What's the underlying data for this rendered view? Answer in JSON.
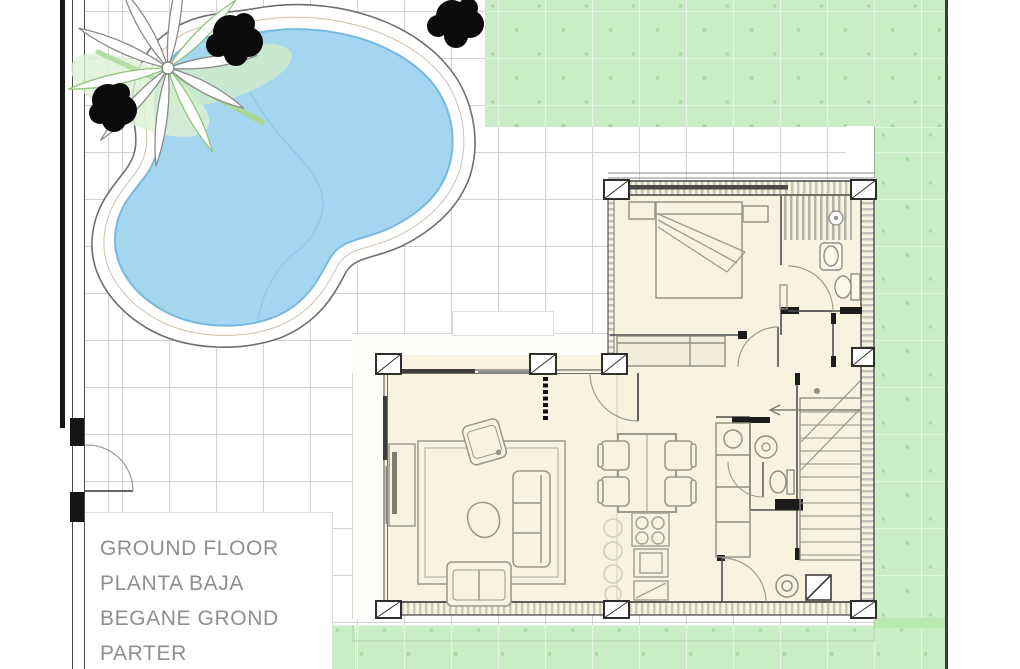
{
  "title_block": {
    "lines": [
      "GROUND FLOOR",
      "PLANTA BAJA",
      "BEGANE GROND",
      "PARTER"
    ]
  },
  "palette": {
    "pool_water": "#a5d6ef",
    "pool_edge": "#79b9de",
    "coping_line": "#6e6e6e",
    "lawn_green": "#c9eec5",
    "grass_mark_green": "#a6d79f",
    "floor_cream": "#f7f3de",
    "tile_joint_gray": "#d2d2d2",
    "wall_dark": "#3f3f3f",
    "furniture_gray": "#97978a",
    "label_gray": "#8f8f8f"
  }
}
